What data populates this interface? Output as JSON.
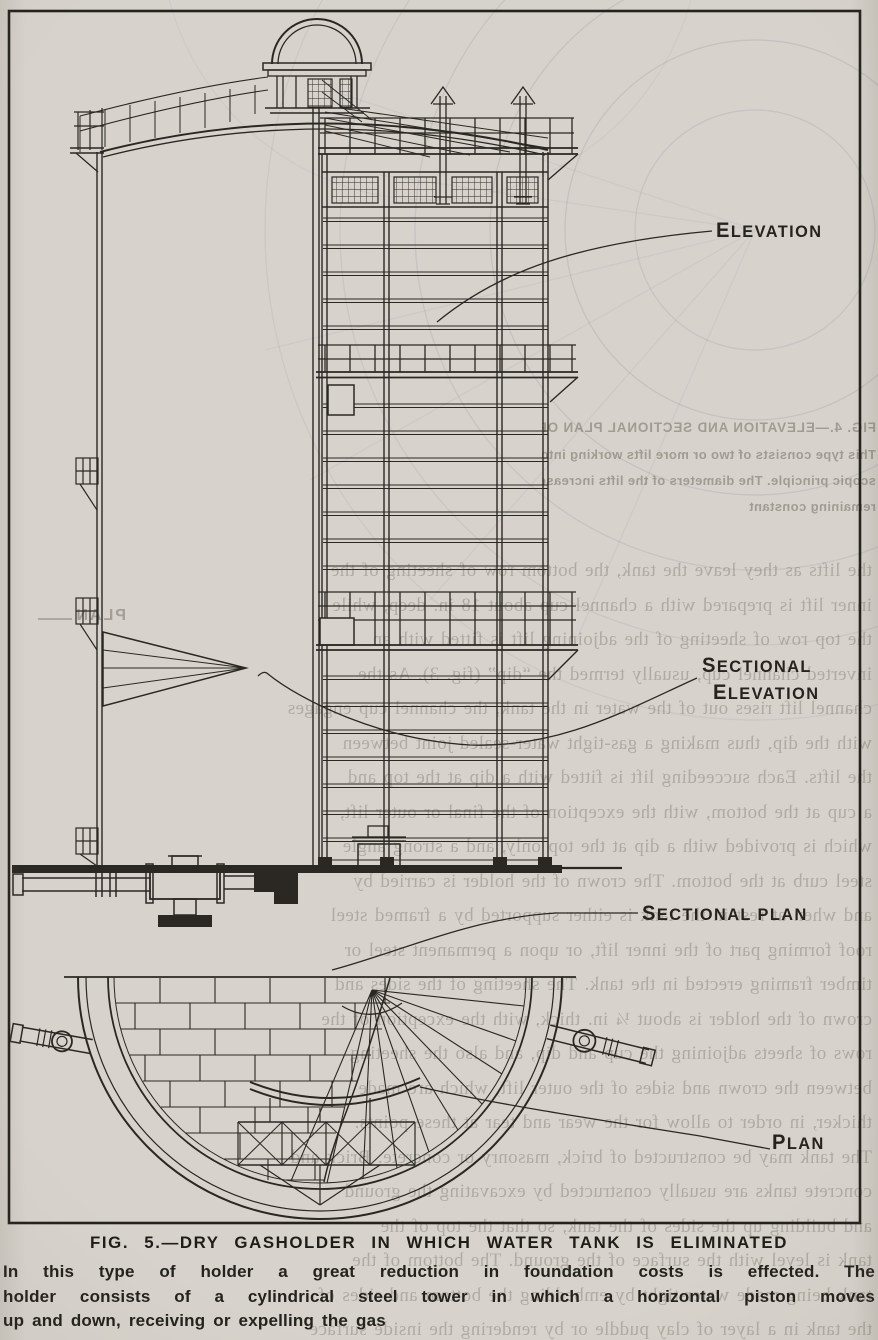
{
  "figure_labels": {
    "elevation": "ELEVATION",
    "sectional_elevation": [
      "SECTIONAL",
      "ELEVATION"
    ],
    "sectional_plan": "SECTIONAL PLAN",
    "plan": "PLAN"
  },
  "caption": {
    "title": "FIG. 5.—DRY GASHOLDER IN WHICH WATER TANK IS ELIMINATED",
    "body_lines": [
      "In this type of holder a great reduction in foundation costs is effected.  The",
      "holder consists of a cylindrical steel tower in which a horizontal piston moves",
      "up and down, receiving or expelling the gas"
    ]
  },
  "bleed_through": {
    "fig4_caption_lines": [
      "FIG. 4.—ELEVATION AND SECTIONAL PLAN OF TELESCOPIC GASHOLDERS",
      "This type consists of two or more lifts working into each other on the tele-",
      "scopic principle.  The diameters of the lifts increase by 2 ft., the depths",
      "remaining constant"
    ],
    "plan_label": "PLAN",
    "body_lines": [
      "the lifts as they leave the tank, the bottom row of sheeting of the",
      "inner lift is prepared with a channel cup about 18 in. deep, while",
      "the top row of sheeting of the adjoining lift is fitted with an",
      "inverted channel cup, usually termed the “dip” (fig. 3).  As the",
      "channel lift rises out of the water in the tank, the channel cup engages",
      "with the dip, thus making a gas-tight water-sealed joint between",
      "the lifts.  Each succeeding lift is fitted with a dip at the top and",
      "a cup at the bottom, with the exception of the final or outer lift,",
      "which is provided with a dip at the top only, and a strong angle",
      "steel curb at the bottom.  The crown of the holder is carried by",
      "and when at rest in the tank is either supported by a framed steel",
      "roof forming part of the inner lift, or upon a permanent steel or",
      "timber framing erected in the tank.  The sheeting of the sides and",
      "crown of the holder is about ¼ in. thick, with the exception of the",
      "rows of sheets adjoining the cup and dip, and also the sheeting",
      "between the crown and sides of the outer lift, which are made",
      "thicker, in order to allow for the wear and tear at these points.",
      "The tank may be constructed of brick, masonry or concrete.  Brick and",
      "concrete tanks are usually constructed by excavating the ground",
      "and building up the sides of the tank, so that the top of the",
      "tank is level with the surface of the ground.  The bottom of the",
      "tank being made water-tight by embedding the bottom and sides of",
      "the tank in a layer of clay puddle or by rendering the inside surface"
    ]
  },
  "colors": {
    "paper": "#d7d3cc",
    "ink": "#2b2823",
    "caption_ink": "#1f1d19",
    "bleed_ink": "#56504280",
    "bleed_blueprint": "#8d89a8"
  }
}
